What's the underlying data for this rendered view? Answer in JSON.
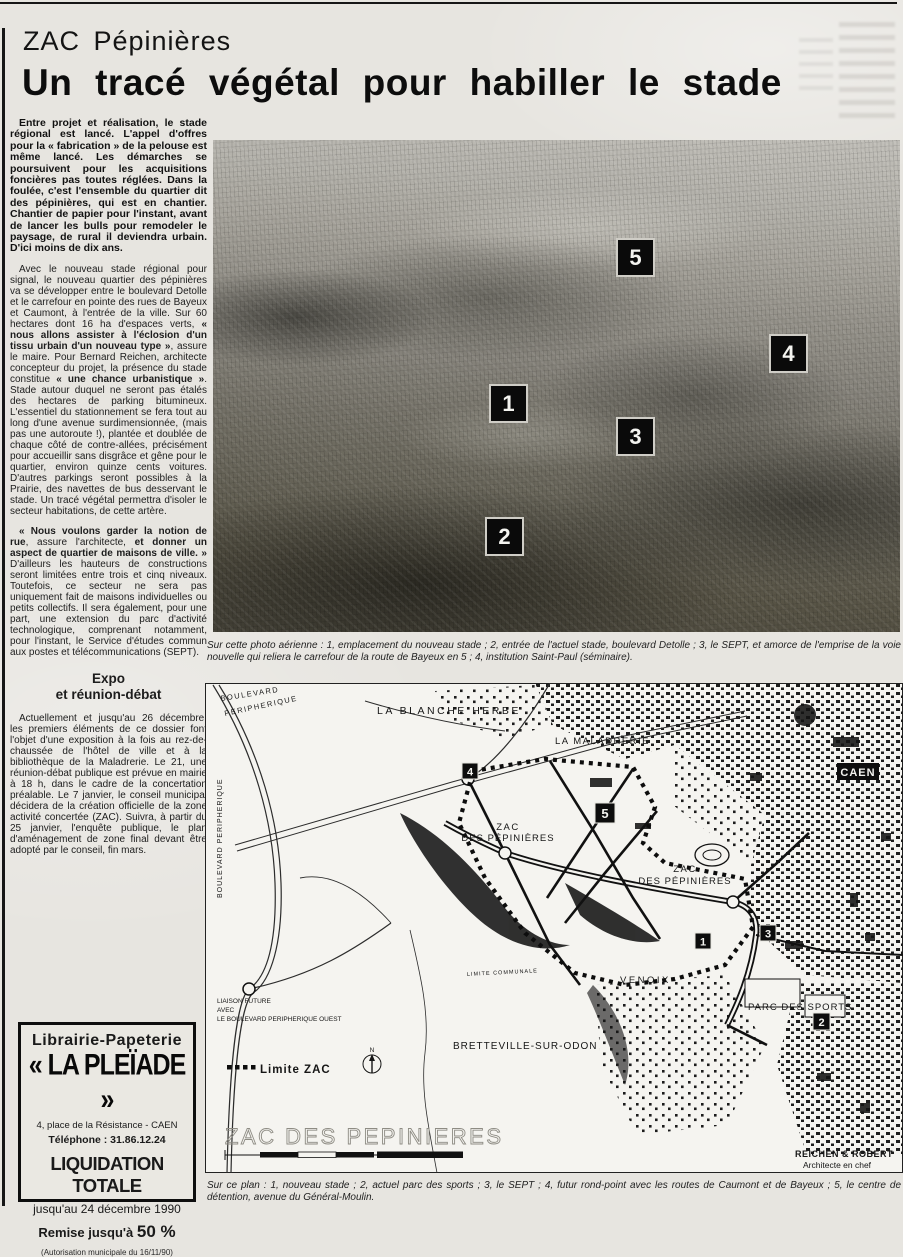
{
  "page": {
    "kicker": "ZAC Pépinières",
    "headline": "Un tracé végétal pour habiller le stade"
  },
  "article": {
    "p1": [
      {
        "t": "Entre projet et réalisation, le stade régional est lancé. L'appel d'offres pour la « fabrication » de la pelouse est même lancé. Les démarches se poursuivent pour les acquisitions foncières pas toutes réglées. Dans la foulée, c'est l'ensemble du quartier dit des pépinières, qui est en chantier. Chantier de papier pour l'instant, avant de lancer les bulls pour remodeler le paysage, de rural il deviendra urbain. D'ici moins de dix ans.",
        "b": true
      }
    ],
    "p2": [
      {
        "t": "Avec le nouveau stade régional pour signal, le nouveau quartier des pépinières va se développer entre le boulevard Detolle et le carrefour en pointe des rues de Bayeux et Caumont, à l'entrée de la ville. Sur 60 hectares dont 16 ha d'espaces verts, "
      },
      {
        "t": "« nous allons assister à l'éclosion d'un tissu urbain d'un nouveau type »",
        "b": true
      },
      {
        "t": ", assure le maire. Pour Bernard Reichen, architecte concepteur du projet, la présence du stade constitue "
      },
      {
        "t": "« une chance urbanistique »",
        "b": true
      },
      {
        "t": ". Stade autour duquel ne seront pas étalés des hectares de parking bitumineux. L'essentiel du stationnement se fera tout au long d'une avenue surdimensionnée, (mais pas une autoroute !), plantée et doublée de chaque côté de contre-allées, précisément pour accueillir sans disgrâce et gêne pour le quartier, environ quinze cents voitures. D'autres parkings seront possibles à la Prairie, des navettes de bus desservant le stade. Un tracé végétal permettra d'isoler le secteur habitations, de cette artère."
      }
    ],
    "p3": [
      {
        "t": "« Nous voulons garder la notion de rue",
        "b": true
      },
      {
        "t": ", assure l'architecte, "
      },
      {
        "t": "et donner un aspect de quartier de maisons de ville. »",
        "b": true
      },
      {
        "t": " D'ailleurs les hauteurs de constructions seront limitées entre trois et cinq niveaux. Toutefois, ce secteur ne sera pas uniquement fait de maisons individuelles ou petits collectifs. Il sera également, pour une part, une extension du parc d'activité technologique, comprenant notamment, pour l'instant, le Service d'études commun aux postes et télécommunications (SEPT)."
      }
    ],
    "subhead_line1": "Expo",
    "subhead_line2": "et réunion-débat",
    "p4": [
      {
        "t": "Actuellement et jusqu'au 26 décembre, les premiers éléments de ce dossier font l'objet d'une exposition à la fois au rez-de-chaussée de l'hôtel de ville et à la bibliothèque de la Maladrerie. Le 21, une réunion-débat publique est prévue en mairie à 18 h, dans le cadre de la concertation préalable. Le 7 janvier, le conseil municipal décidera de la création officielle de la zone activité concertée (ZAC). Suivra, à partir du 25 janvier, l'enquête publique, le plan d'aménagement de zone final devant être adopté par le conseil, fin mars."
      }
    ]
  },
  "photo": {
    "markers": [
      "5",
      "4",
      "1",
      "3",
      "2"
    ],
    "caption": "Sur cette photo aérienne : 1, emplacement du nouveau stade ; 2, entrée de l'actuel stade, boulevard Detolle ; 3, le SEPT, et amorce de l'emprise de la voie nouvelle qui reliera le carrefour de la route de Bayeux en 5 ; 4, institution Saint-Paul (séminaire)."
  },
  "map": {
    "labels": {
      "boulevard": "BOULEVARD",
      "peripherique": "PERIPHERIQUE",
      "boulevard_peripherique_left": "BOULEVARD PERIPHERIQUE",
      "la_blanche_herbe": "LA BLANCHE HERBE",
      "la_maladrerie": "LA MALADRERIE",
      "caen": "CAEN",
      "zac1_line1": "ZAC",
      "zac1_line2": "DES PÉPINIÈRES",
      "zac2_line1": "ZAC",
      "zac2_line2": "DES PÉPINIÈRES",
      "venoix": "VENOIX",
      "parc_des_sports": "PARC DES SPORTS",
      "bretteville": "BRETTEVILLE-SUR-ODON",
      "limite_communale": "LIMITE COMMUNALE",
      "liaison_line1": "LIAISON FUTURE",
      "liaison_line2": "AVEC",
      "liaison_line3": "LE BOULEVARD PERIPHERIQUE OUEST",
      "limite_zac_legend": "Limite ZAC",
      "compass_n": "N",
      "big_title": "ZAC DES PEPINIERES",
      "architect_line1": "REICHEN & ROBERT",
      "architect_line2": "Architecte en chef"
    },
    "markers": [
      "4",
      "5",
      "1",
      "3",
      "2"
    ],
    "caption": "Sur ce plan : 1, nouveau stade ; 2, actuel parc des sports ; 3, le SEPT ; 4, futur rond-point avec les routes de Caumont et de Bayeux ; 5, le centre de détention, avenue du Général-Moulin."
  },
  "ad": {
    "line1": "Librairie-Papeterie",
    "name": "« LA PLEÏADE »",
    "address": [
      {
        "t": "4, place de la Résistance - "
      },
      {
        "t": "CAEN",
        "b": true
      }
    ],
    "phone": "Téléphone : 31.86.12.24",
    "liquidation": "LIQUIDATION TOTALE",
    "until": "jusqu'au 24 décembre 1990",
    "discount_label": "Remise jusqu'à ",
    "discount_value": "50 %",
    "authorization": "(Autorisation municipale du 16/11/90)"
  },
  "colors": {
    "paper": "#e7e5e0",
    "ink": "#1a1a1a",
    "plaque_bg": "#0a0a0a",
    "plaque_fg": "#f4f4f0"
  }
}
